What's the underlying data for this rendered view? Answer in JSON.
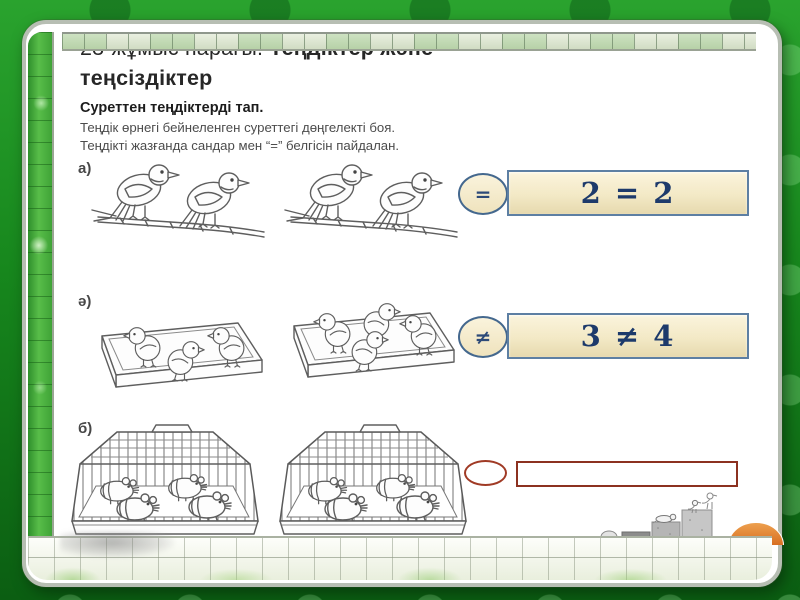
{
  "slide": {
    "title": {
      "prefix": "23-жұмыс парағы. ",
      "bold_line1": "Теңдіктер және",
      "bold_line2": "теңсіздіктер"
    },
    "task": {
      "heading": "Суреттен теңдіктерді тап.",
      "line1": "Теңдік өрнегі бейнеленген суреттегі дөңгелекті боя.",
      "line2": "Теңдікті жазғанда сандар мен “=” белгісін пайдалан."
    },
    "rows": [
      {
        "label": "а)",
        "subject": "birds-on-branches",
        "left_count": 2,
        "right_count": 2,
        "sign": "=",
        "answer": "2 = 2"
      },
      {
        "label": "ә)",
        "subject": "chicks-in-trays",
        "left_count": 3,
        "right_count": 4,
        "sign": "≠",
        "answer": "3 ≠ 4"
      },
      {
        "label": "б)",
        "subject": "hamsters-in-cages",
        "left_count": 4,
        "right_count": 4,
        "sign": "",
        "answer": ""
      }
    ],
    "colors": {
      "answer_box_fill": "#f3e9c6",
      "answer_box_border": "#5d7fa3",
      "answer_text": "#1d3a6b",
      "empty_field_border": "#8c3120",
      "background_green": "#17871d"
    }
  }
}
